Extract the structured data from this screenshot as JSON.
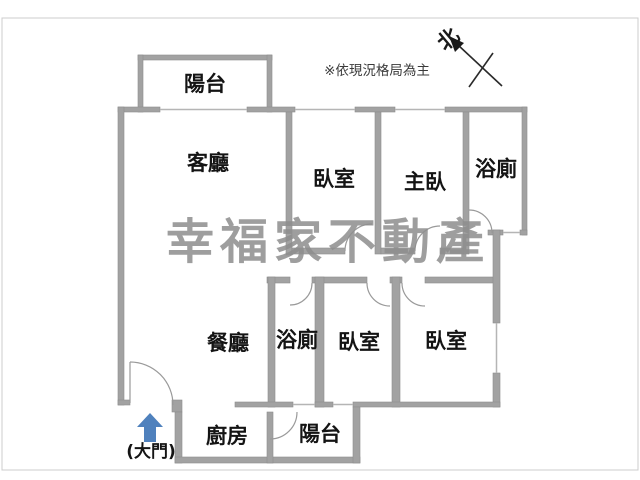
{
  "plan": {
    "disclaimer": "※依現況格局為主",
    "compass_label": "北",
    "watermark": "幸福家不動產",
    "entrance_label": "(大門)",
    "colors": {
      "wall": "#a2a2a2",
      "window_line": "#b5b5b5",
      "label_text": "#141414",
      "entrance_arrow_blue": "#4f81bd",
      "watermark_gray": "#8e8e8e"
    },
    "rooms": [
      {
        "id": "balcony-top",
        "label": "陽台"
      },
      {
        "id": "living-room",
        "label": "客廳"
      },
      {
        "id": "bedroom-top",
        "label": "臥室"
      },
      {
        "id": "master-bedroom",
        "label": "主臥"
      },
      {
        "id": "bathroom-top",
        "label": "浴廁"
      },
      {
        "id": "dining-room",
        "label": "餐廳"
      },
      {
        "id": "bathroom-bottom",
        "label": "浴廁"
      },
      {
        "id": "bedroom-bottom-left",
        "label": "臥室"
      },
      {
        "id": "bedroom-bottom-right",
        "label": "臥室"
      },
      {
        "id": "kitchen",
        "label": "廚房"
      },
      {
        "id": "balcony-bottom",
        "label": "陽台"
      }
    ]
  }
}
